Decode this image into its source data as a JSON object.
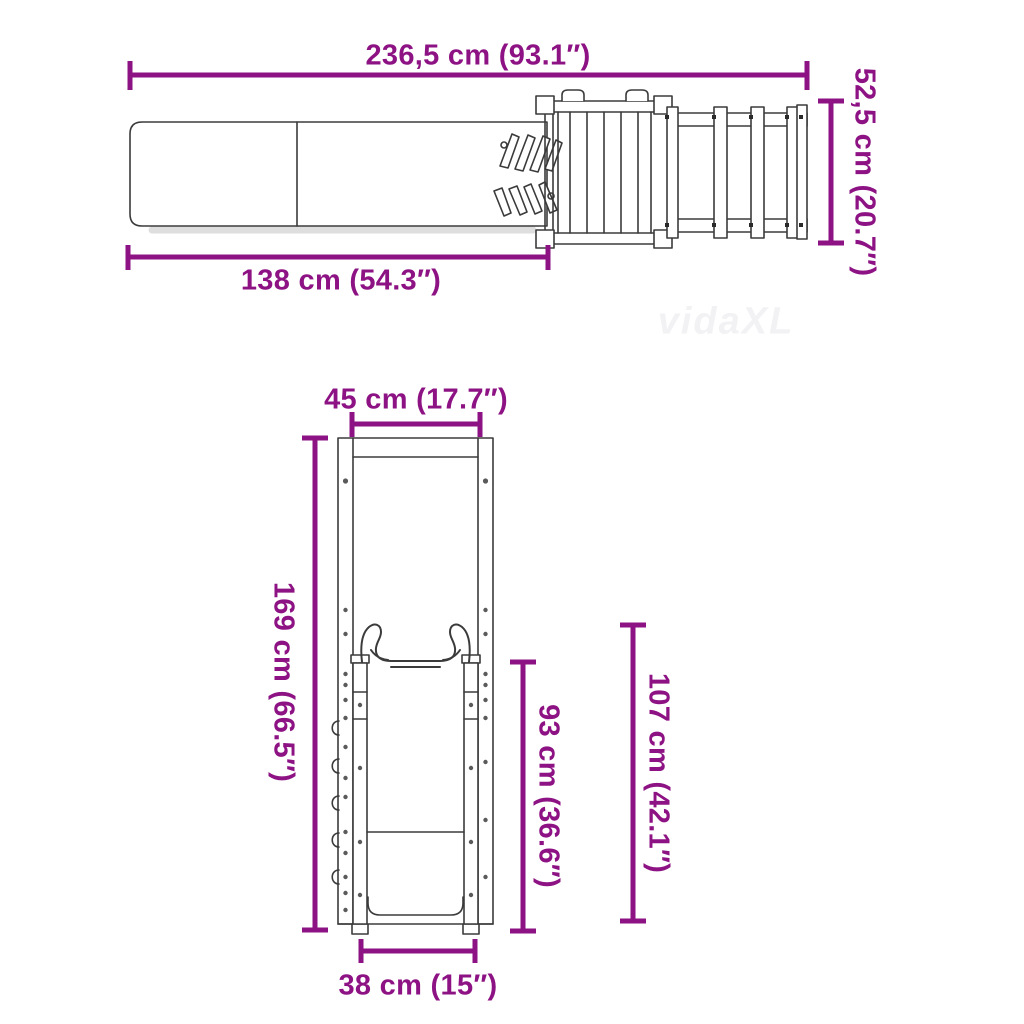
{
  "colors": {
    "dimension": "#8D1283",
    "line": "#3b3b3b",
    "shadow": "#dedede"
  },
  "watermark": {
    "text": "vidaXL"
  },
  "top_view": {
    "description": "top view of playset: slide, platform with climbing wall, ladder",
    "dims": {
      "total_width": "236,5 cm (93.1″)",
      "slide_length": "138 cm (54.3″)",
      "structure_height": "52,5 cm (20.7″)"
    }
  },
  "front_view": {
    "description": "front view of slide tower",
    "dims": {
      "top_width": "45 cm (17.7″)",
      "total_height": "169 cm (66.5″)",
      "slide_height": "93 cm (36.6″)",
      "handle_height": "107 cm (42.1″)",
      "bottom_width": "38 cm (15″)"
    }
  }
}
